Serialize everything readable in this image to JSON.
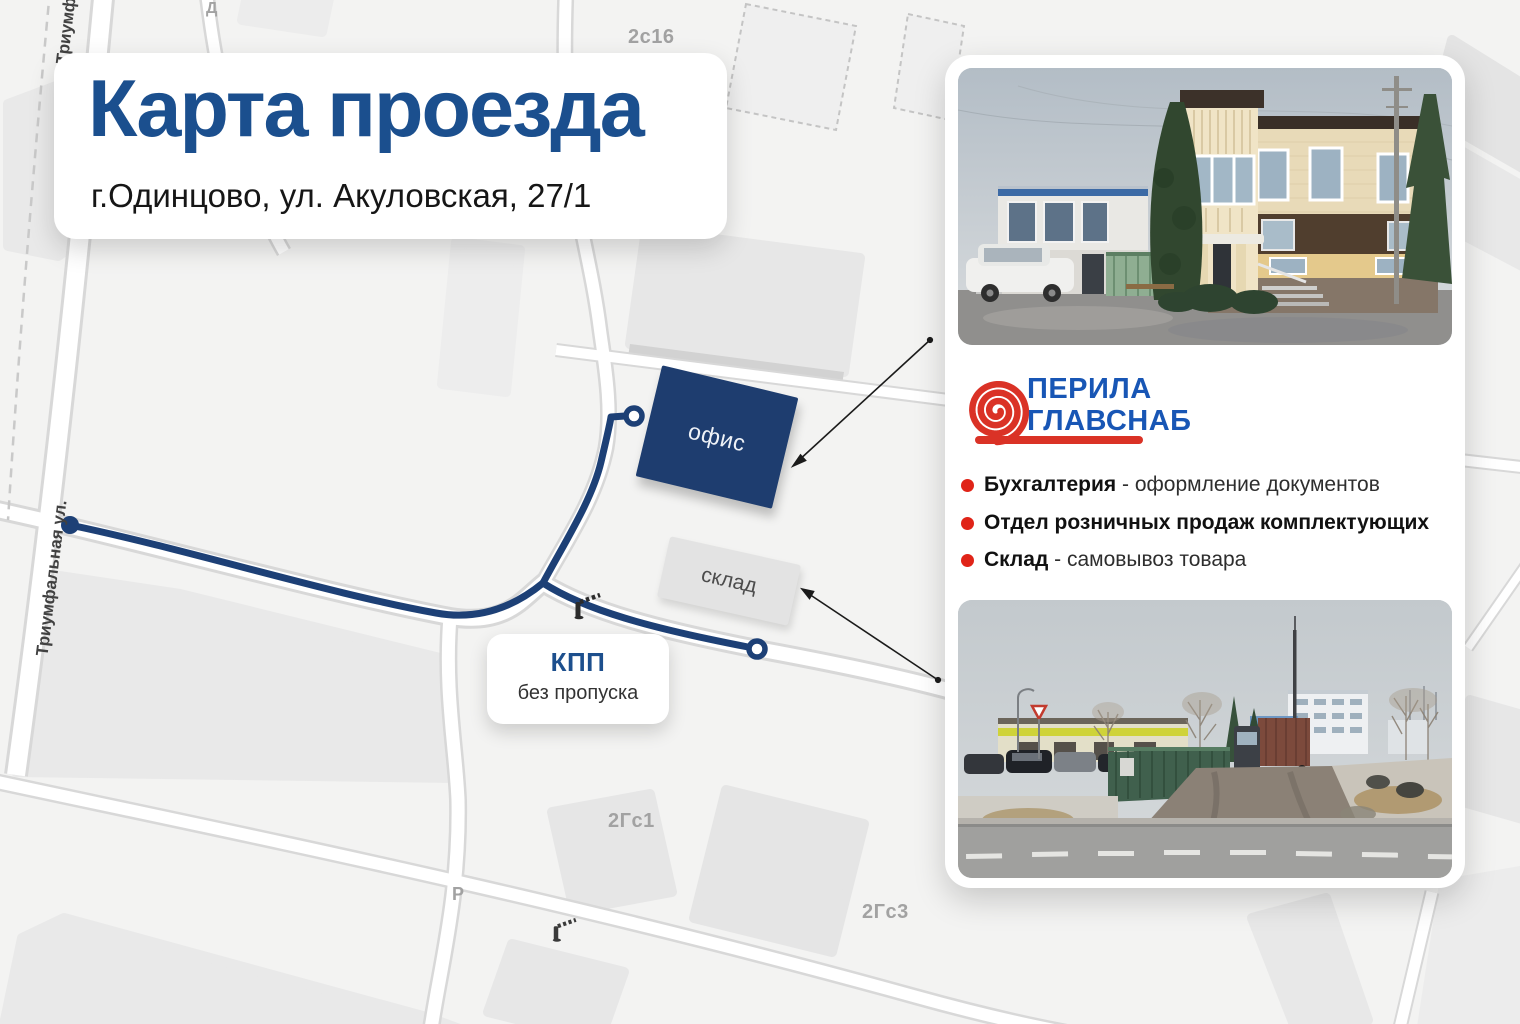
{
  "title_card": {
    "title": "Карта проезда",
    "subtitle": "г.Одинцово, ул. Акуловская, 27/1"
  },
  "map": {
    "street_label": "Триумфальная ул.",
    "street_label_top": "Триумфальная ул.",
    "office_label": "офис",
    "warehouse_label": "склад",
    "checkpoint": {
      "title": "КПП",
      "subtitle": "без пропуска"
    },
    "parcel_labels": {
      "d": "Д",
      "s2c16": "2с16",
      "g2c1": "2Гс1",
      "p": "Р",
      "g2c3": "2Гс3"
    }
  },
  "panel": {
    "logo": {
      "line1": "ПЕРИЛА",
      "line2": "ГЛАВСНАБ"
    },
    "bullets": [
      {
        "bold": "Бухгалтерия",
        "rest": " - оформление документов"
      },
      {
        "bold": "Отдел розничных продаж комплектующих",
        "rest": ""
      },
      {
        "bold": "Склад",
        "rest": " - самовывоз товара"
      }
    ]
  },
  "colors": {
    "title_blue": "#1b4f8e",
    "route_navy": "#1d4076",
    "office_navy": "#1e3d6f",
    "logo_blue": "#1856b5",
    "logo_red": "#da3226",
    "bullet_red": "#e02418",
    "map_bg": "#f3f3f2",
    "building_gray": "#e8e8e8"
  }
}
